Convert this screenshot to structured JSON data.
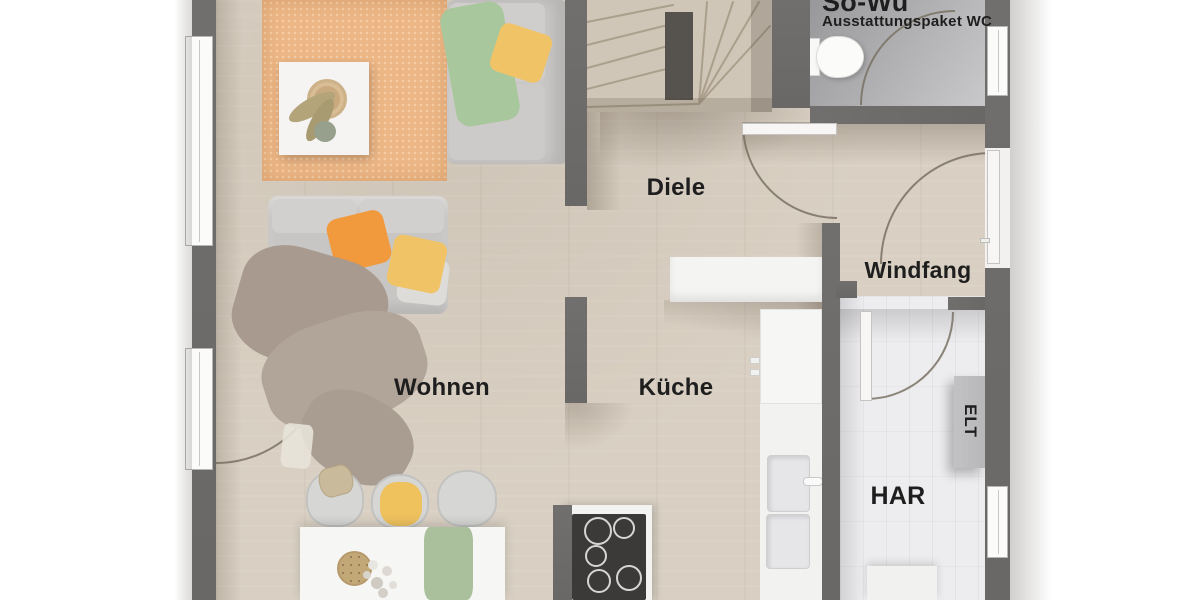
{
  "rooms": {
    "wohnen": {
      "label": "Wohnen"
    },
    "kueche": {
      "label": "Küche"
    },
    "diele": {
      "label": "Diele"
    },
    "windfang": {
      "label": "Windfang"
    },
    "har": {
      "label": "HAR"
    },
    "elt": {
      "label": "ELT"
    },
    "wc": {
      "label": "Sö-Wu",
      "sublabel": "Ausstattungspaket WC"
    }
  },
  "colors": {
    "wall": "#6a6866",
    "wood": "#d9d0c3",
    "wc_floor": "#98989a",
    "har_floor": "#ededef",
    "rug": "#ecb685",
    "sofa": "#cac8c6",
    "blanket_green": "#a9c79c",
    "blanket_taupe": "#a89a8e",
    "pillow_orange": "#f0993d",
    "pillow_yellow": "#f0c466",
    "counter": "#f4f4f2",
    "cooktop": "#3b3a38",
    "stairs": "#cfc6b8",
    "stair_rail": "#56534e",
    "elt_box": "#b7b7b9",
    "runner_green": "#aabf9c",
    "text": "#1e1e1e"
  }
}
